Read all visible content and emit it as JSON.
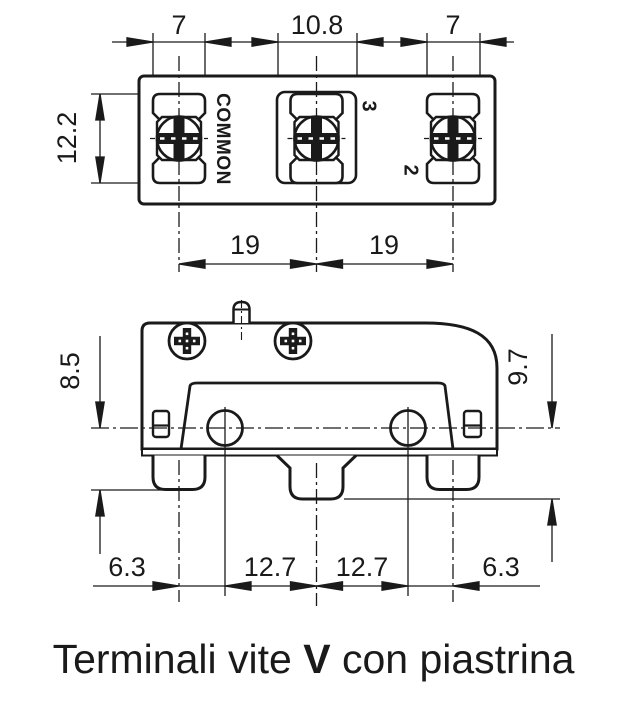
{
  "caption": {
    "prefix": "Terminali vite ",
    "bold": "V",
    "suffix": " con piastrina"
  },
  "top_view": {
    "dims": {
      "width_left": "7",
      "width_center": "10.8",
      "width_right": "7",
      "terminal_height": "12.2",
      "pitch_left": "19",
      "pitch_right": "19"
    },
    "labels": {
      "terminal_common": "COMMON",
      "terminal_no": "3",
      "terminal_nc": "2"
    }
  },
  "side_view": {
    "dims": {
      "height_left": "8.5",
      "height_right": "9.7",
      "bottom_offset_left": "6.3",
      "bottom_pitch_left": "12.7",
      "bottom_pitch_right": "12.7",
      "bottom_offset_right": "6.3"
    }
  },
  "colors": {
    "line": "#1a1a1a",
    "background": "#ffffff"
  }
}
